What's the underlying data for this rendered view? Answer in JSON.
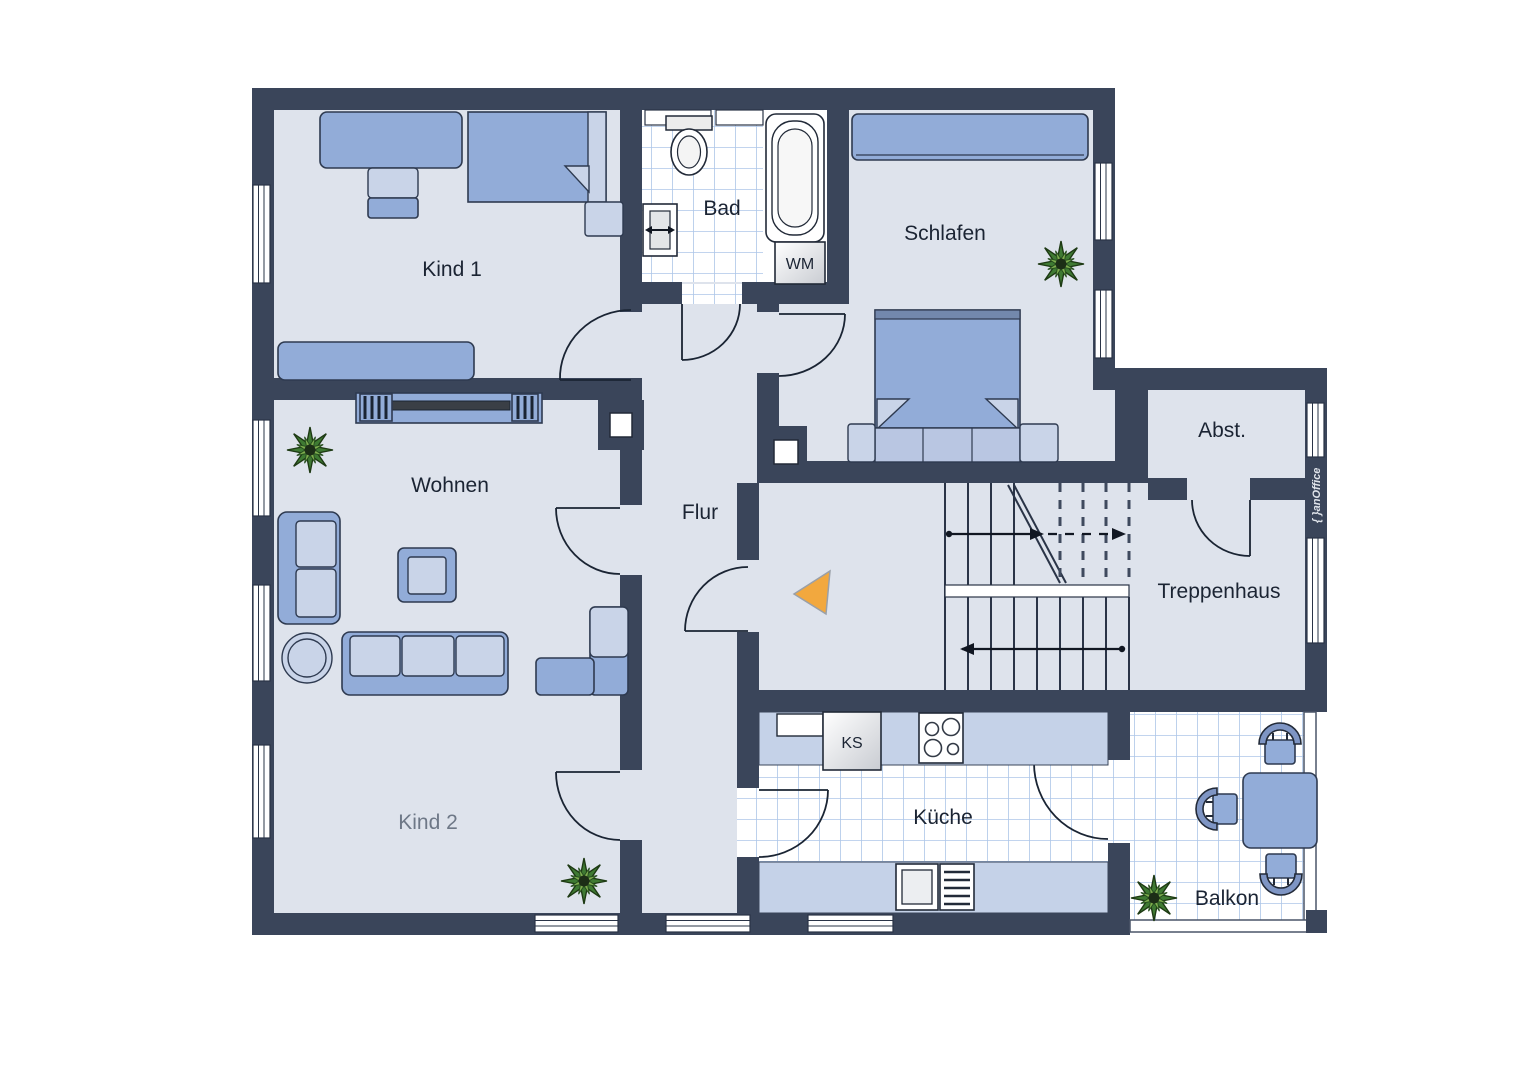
{
  "rooms": {
    "kind1": {
      "label": "Kind 1"
    },
    "bad": {
      "label": "Bad"
    },
    "schlafen": {
      "label": "Schlafen"
    },
    "wohnen": {
      "label": "Wohnen"
    },
    "flur": {
      "label": "Flur"
    },
    "abst": {
      "label": "Abst."
    },
    "treppenhaus": {
      "label": "Treppenhaus"
    },
    "kind2": {
      "label": "Kind 2"
    },
    "kueche": {
      "label": "Küche"
    },
    "balkon": {
      "label": "Balkon"
    }
  },
  "appliances": {
    "washing_machine": "WM",
    "fridge": "KS"
  },
  "brand": {
    "logo_text": "{ }anOffice"
  },
  "colors": {
    "wall": "#3A455A",
    "floor": "#DEE3EC",
    "furniture": "#92ACD8",
    "furniture_light": "#C9D4E8",
    "counter": "#C5D2E8",
    "tile_line": "#ADC6E8",
    "entrance_arrow": "#F2A83E",
    "label": "#1B2433",
    "label_muted": "#6E7887",
    "plant_dark": "#3F7A33",
    "plant_light": "#7FB04F"
  }
}
